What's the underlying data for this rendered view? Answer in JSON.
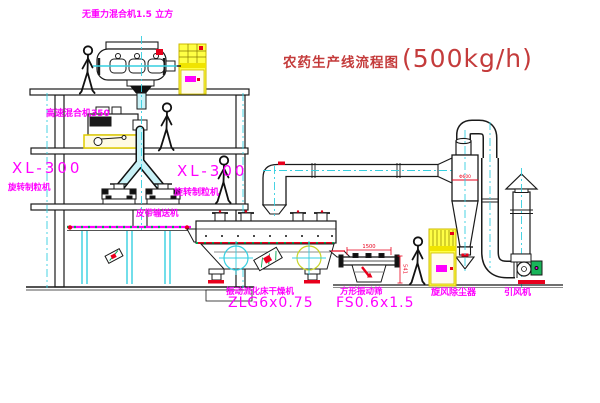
{
  "title": {
    "name": "农药生产线流程图",
    "capacity": "(500kg/h)"
  },
  "equipment": {
    "gravity_mixer": "无重力混合机1.5 立方",
    "high_speed_mixer": "高速混合机350",
    "granulator_left_model": "XL-300",
    "granulator_left_name": "旋转制粒机",
    "granulator_right_model": "XL-300",
    "granulator_right_name": "旋转制粒机",
    "belt_conveyor": "皮带输送机",
    "dryer_name": "振动流化床干燥机",
    "dryer_model": "ZLG6x0.75",
    "sieve_name": "方形振动筛",
    "sieve_model": "FS0.6x1.5",
    "cyclone_name": "旋风除尘器",
    "fan_name": "引风机"
  },
  "dimensions": {
    "sieve_length": "1500",
    "sieve_height": "541",
    "cyclone_diameter": "Φ600"
  },
  "colors": {
    "label_magenta": "#ff00ff",
    "title_red": "#c43b3b",
    "line_black": "#1a1a1a",
    "pipe_cyan": "#35cfe0",
    "cabinet_yellow": "#ffff45",
    "accent_red": "#e8001c",
    "accent_green": "#00a651"
  }
}
